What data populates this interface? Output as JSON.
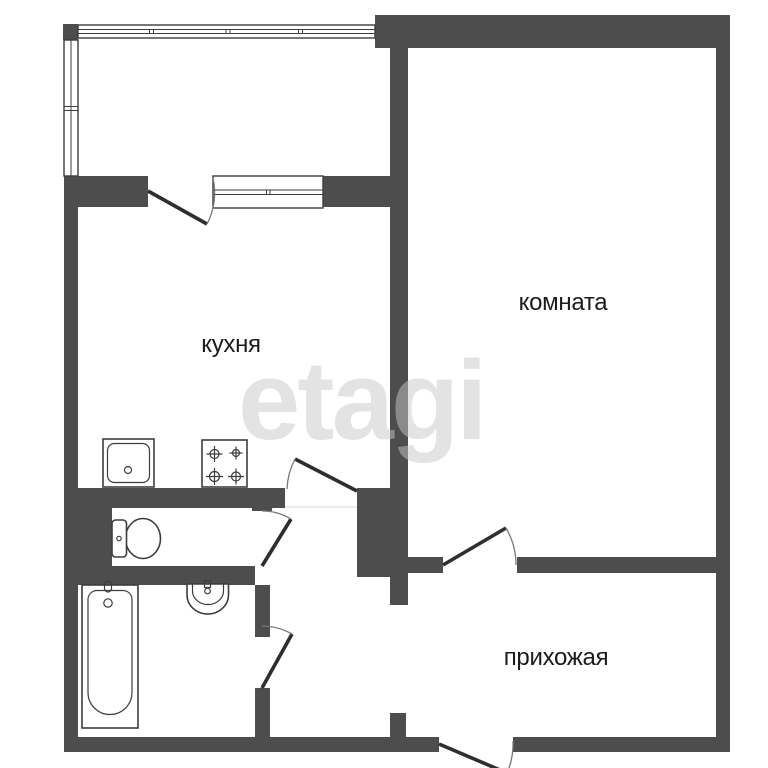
{
  "title": "apartment-floor-plan",
  "watermark": {
    "text": "etagi"
  },
  "rooms": {
    "kitchen": {
      "label": "кухня"
    },
    "living_room": {
      "label": "комната"
    },
    "hallway": {
      "label": "прихожая"
    }
  },
  "fixtures": {
    "kitchen_sink": "kitchen-sink-icon",
    "stove": "stove-burners-icon",
    "toilet": "toilet-icon",
    "bathtub": "bathtub-icon",
    "washbasin": "washbasin-icon",
    "balcony_window": "window-icon",
    "kitchen_window": "window-sill-icon"
  },
  "colors": {
    "background": "#ffffff",
    "wall": "#4d4d4d",
    "line": "#3d3d3d",
    "door": "#2e2e2e",
    "arc": "#777777",
    "text": "#1b1b1b",
    "watermark": "#c8c8c8"
  }
}
